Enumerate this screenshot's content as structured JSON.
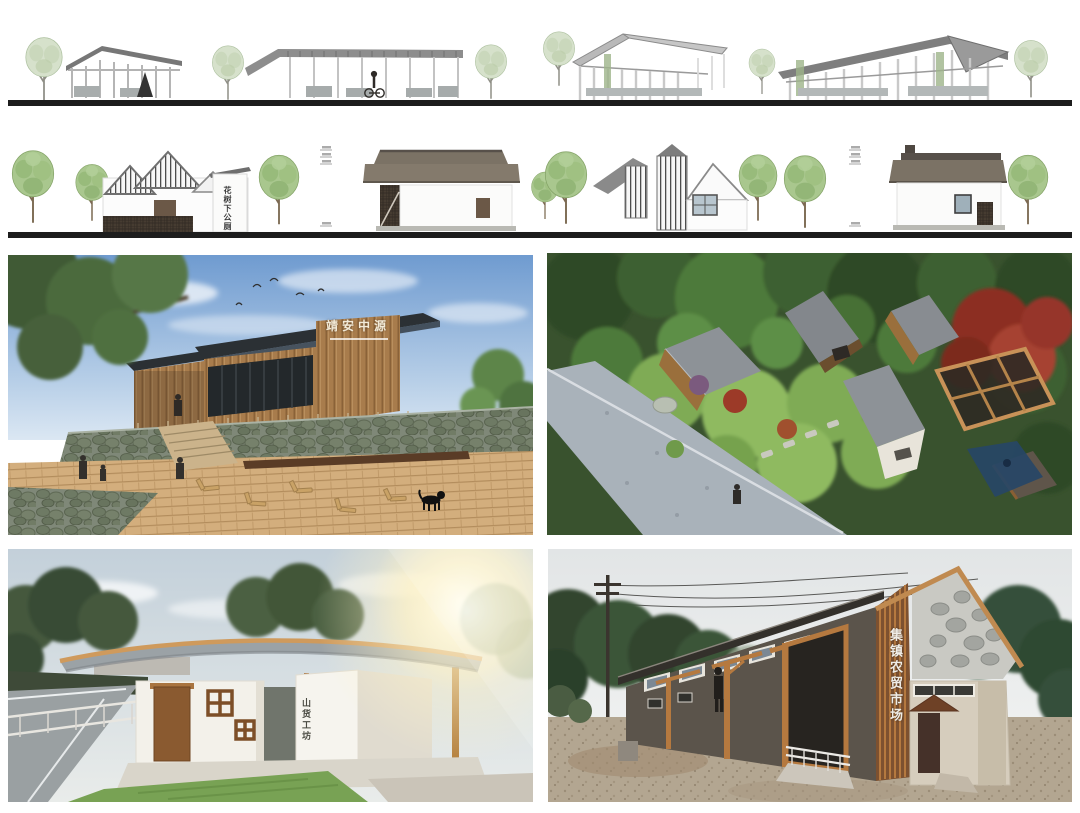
{
  "signs": {
    "row2_building": "花树下公厕",
    "visitor_center_title": "靖安中源",
    "toilet_pavilion": "山货工坊",
    "market": "集镇农贸市场"
  },
  "palette": {
    "paper": "#ffffff",
    "ground_line": "#1d1d1d",
    "elevation_roof_gray": "#8d8d8d",
    "elevation_tree_pale": "#d6e1cb",
    "elevation_tree_green": "#a9c78e",
    "brown_roof": "#7b7265",
    "sky_blue": "#6f9bd0",
    "deck_wood": "#d3ae7d",
    "stone_wall": "#7f8878",
    "dark_roof_slab": "#2b3034",
    "maple_red": "#8c2d20",
    "timber_orange": "#b5793f",
    "lawn_green": "#78a254",
    "market_wall": "#5b544b",
    "sun_flare": "#fff3c8"
  }
}
